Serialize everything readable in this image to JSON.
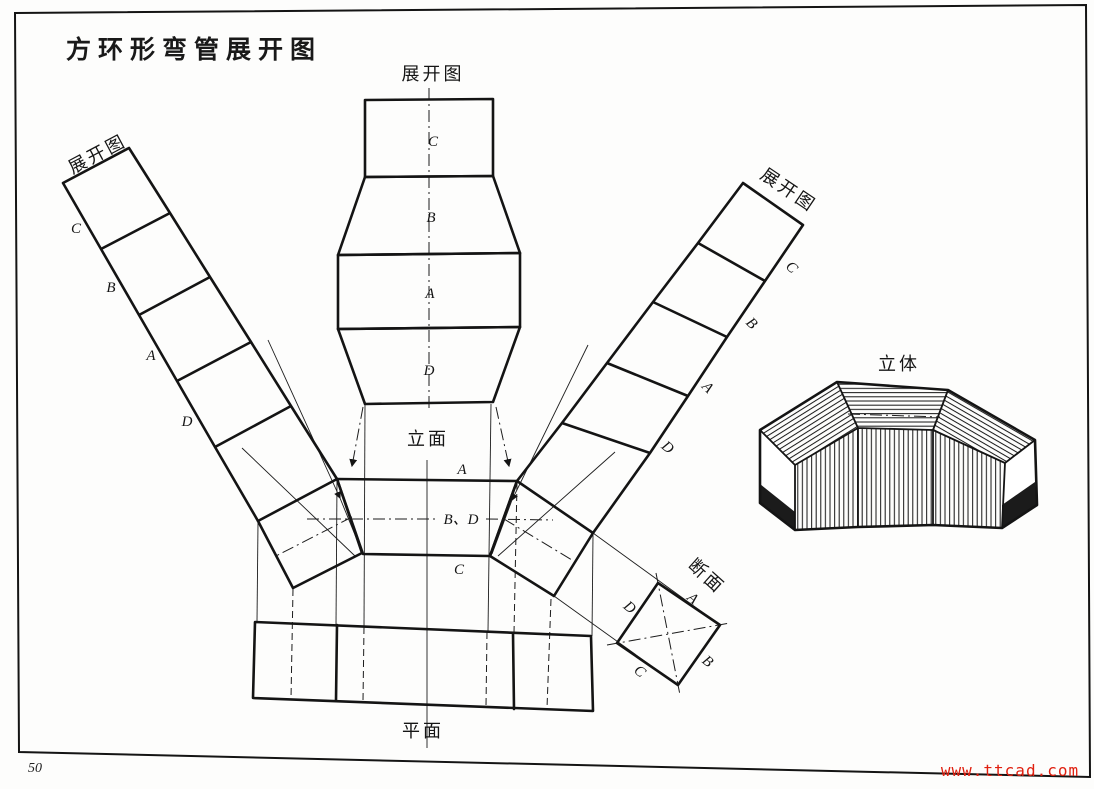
{
  "page": {
    "title": "方环形弯管展开图",
    "page_number": "50",
    "watermark": "www.ttcad.com"
  },
  "views": {
    "development_top": {
      "label": "展开图",
      "letters": {
        "c": "C",
        "b": "B",
        "a": "A",
        "d": "D"
      }
    },
    "development_left": {
      "label": "展开图",
      "letters": {
        "c": "C",
        "b": "B",
        "a": "A",
        "d": "D"
      }
    },
    "development_right": {
      "label": "展开图",
      "letters": {
        "c": "C",
        "b": "B",
        "a": "A",
        "d": "D"
      }
    },
    "elevation": {
      "label": "立面",
      "letters": {
        "a": "A",
        "bd": "B、D",
        "c": "C"
      }
    },
    "plan": {
      "label": "平面"
    },
    "section": {
      "label": "断面",
      "letters": {
        "a": "A",
        "b": "B",
        "c": "C",
        "d": "D"
      }
    },
    "pictorial": {
      "label": "立体"
    }
  },
  "colors": {
    "ink": "#141414",
    "watermark_red": "#e02010",
    "paper": "#fdfdfc"
  }
}
